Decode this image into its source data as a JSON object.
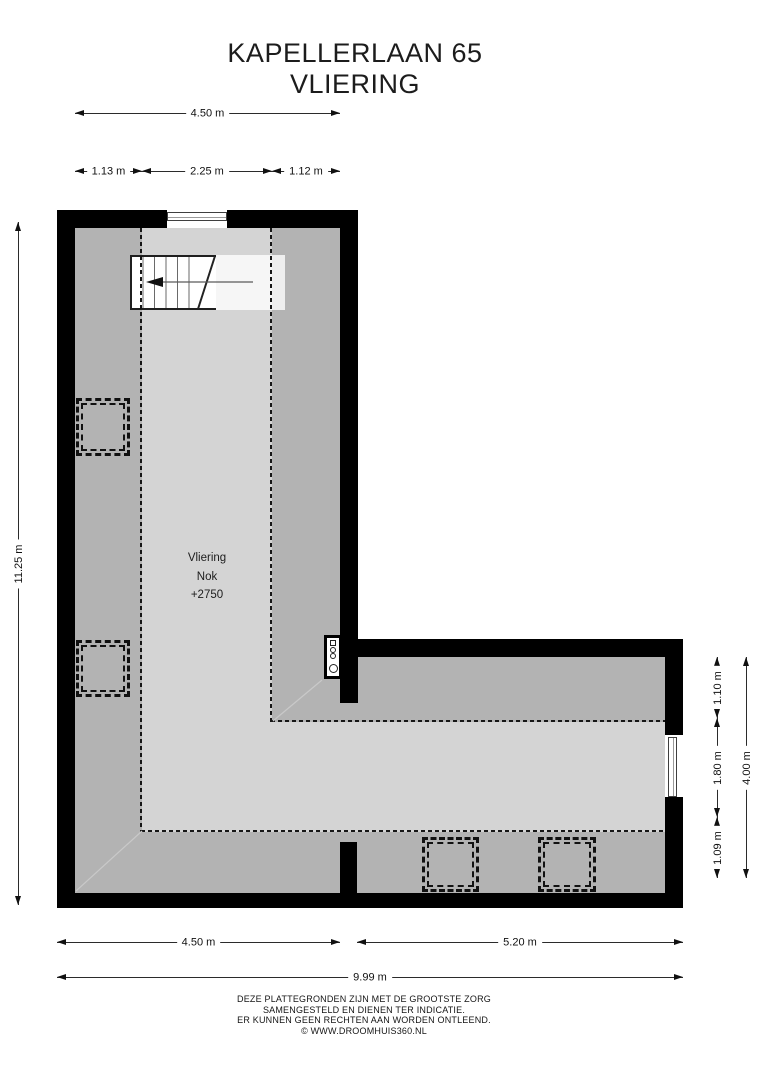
{
  "title": {
    "line1": "KAPELLERLAAN 65",
    "line2": "VLIERING"
  },
  "room_label": {
    "name": "Vliering",
    "ridge_label": "Nok",
    "ridge_height": "+2750"
  },
  "dimensions": {
    "top_total": "4.50 m",
    "top_segments": [
      "1.13 m",
      "2.25 m",
      "1.12 m"
    ],
    "left_total": "11.25 m",
    "right_segments": [
      "1.10 m",
      "1.80 m",
      "1.09 m"
    ],
    "right_total": "4.00 m",
    "bottom_segments": [
      "4.50 m",
      "5.20 m"
    ],
    "bottom_total": "9.99 m"
  },
  "footer": {
    "line1": "DEZE PLATTEGRONDEN ZIJN MET DE GROOTSTE ZORG",
    "line2": "SAMENGESTELD EN DIENEN TER INDICATIE.",
    "line3": "ER KUNNEN GEEN RECHTEN AAN WORDEN ONTLEEND.",
    "line4": "© WWW.DROOMHUIS360.NL"
  },
  "icons": {
    "stairs": "staircase-with-down-arrow",
    "boiler": "boiler-unit",
    "roof_window": "double-dashed-square",
    "window": "double-line-window"
  },
  "colors": {
    "wall": "#000000",
    "floor_low_headroom": "#b3b3b3",
    "floor_high_headroom": "#d4d4d4",
    "background": "#ffffff",
    "dimension_text": "#111111"
  }
}
